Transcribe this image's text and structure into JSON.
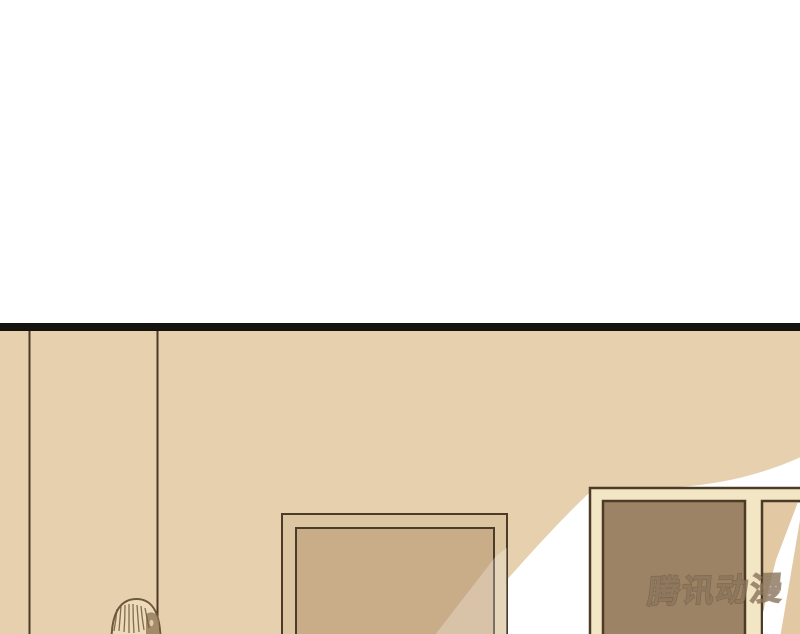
{
  "watermark": {
    "text": "腾讯动漫"
  },
  "colors": {
    "page_background": "#ffffff",
    "black_bar": "#151210",
    "wall": "#e6d0ae",
    "line_dark": "#4c3b27",
    "swoosh": "#ffffff",
    "frame_band": "#dcc5a1",
    "frame_panel": "#c9ac88",
    "door_trim": "#f3e6c5",
    "door_panel": "#9d8365",
    "right_panel": "#e2c9a4",
    "hair_fill": "#ecdab9",
    "hair_line": "#6f583c",
    "face_shadow": "#967b5a"
  }
}
